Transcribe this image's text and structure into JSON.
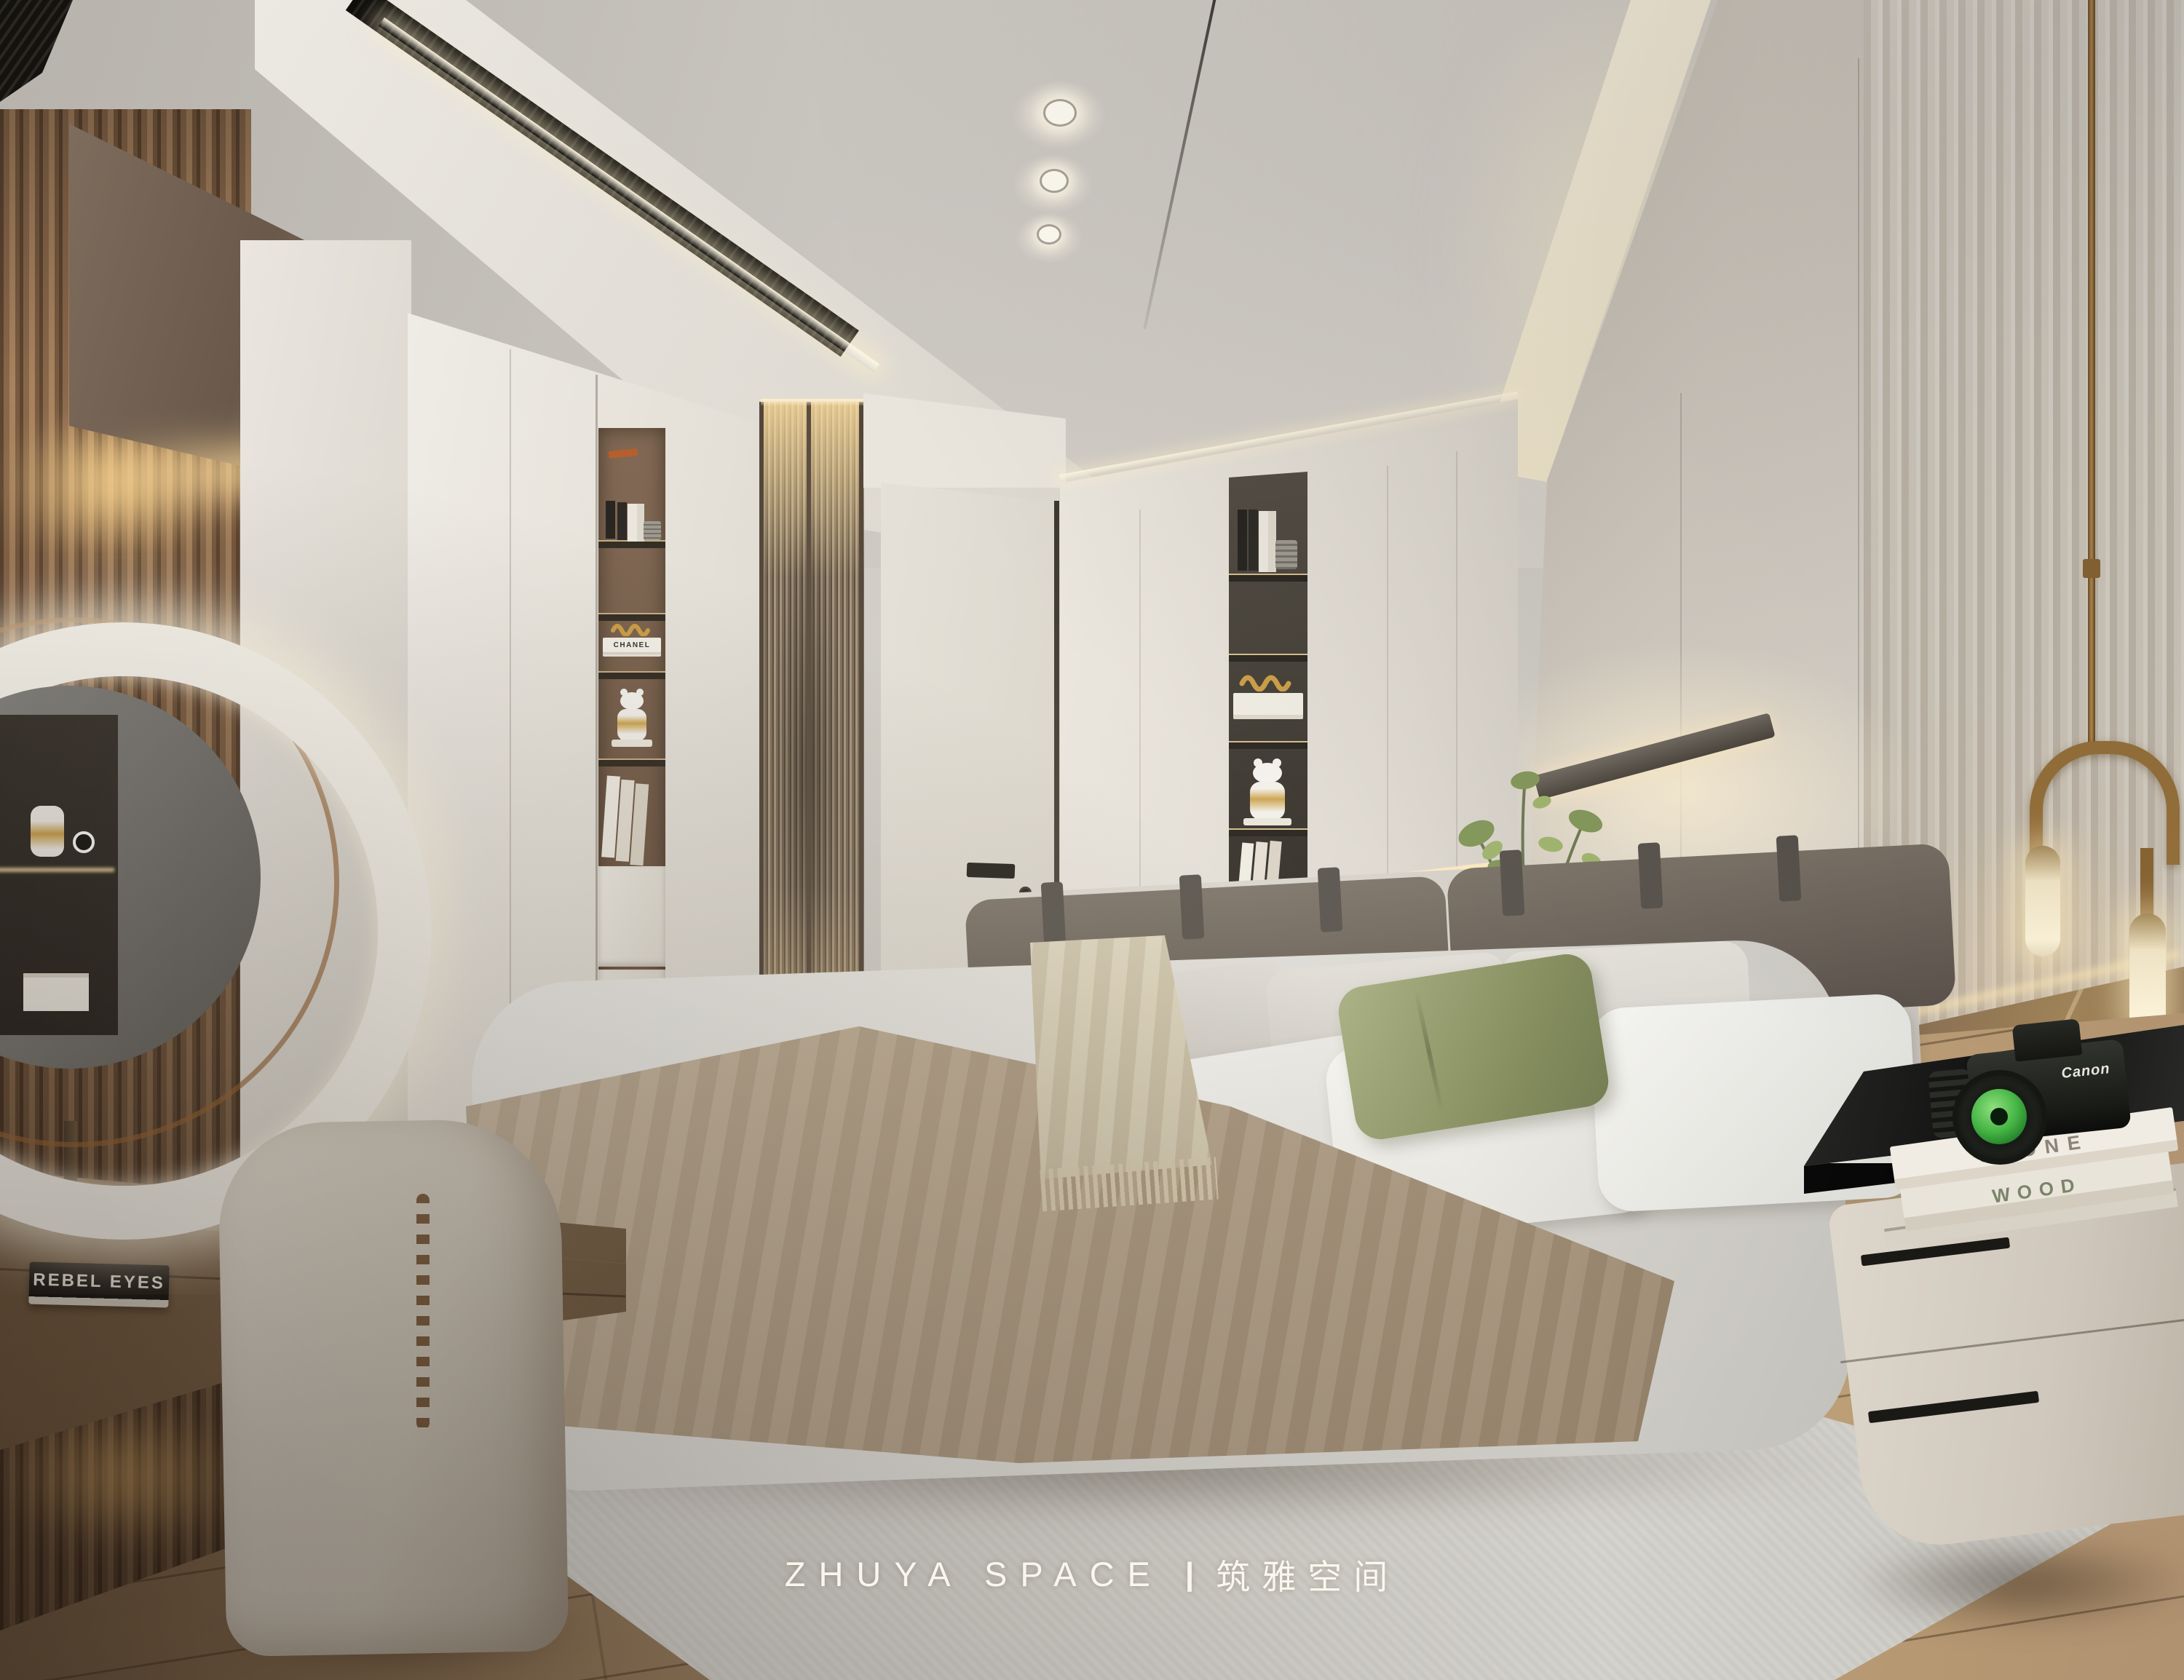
{
  "watermark": {
    "brand": "ZHUYA SPACE",
    "divider": "|",
    "studio_cn": "筑雅空间"
  },
  "decor": {
    "vanity_book_cover": "REBEL EYES",
    "shelf_book_spine": "CHANEL",
    "nightstand_book_top": "STONE",
    "nightstand_book_bottom": "WOOD",
    "camera_brand": "Canon"
  },
  "palette": {
    "ceiling_grey": "#c8c4be",
    "cove_warm_white": "#fdf6e4",
    "wall_greige": "#d9d3cb",
    "cabinet_white": "#e9e5de",
    "slat_wood": "#9b7b5f",
    "warm_glow": "#f7e8c8",
    "vanity_taupe": "#8d7258",
    "glass_bronze": "#8a7a67",
    "niche_dark": "#3c3834",
    "bed_fabric": "#d9d6d1",
    "headboard_brown": "#6a6158",
    "pillow_green": "#97a06f",
    "blanket_taupe": "#b29c85",
    "rug_grey": "#dedcd7",
    "floor_wood": "#a98e72",
    "marble_brown": "#8a7053",
    "brass": "#a77f4a",
    "nightstand_top_black": "#1b1b1a",
    "camera_lens_green": "#46b545"
  }
}
